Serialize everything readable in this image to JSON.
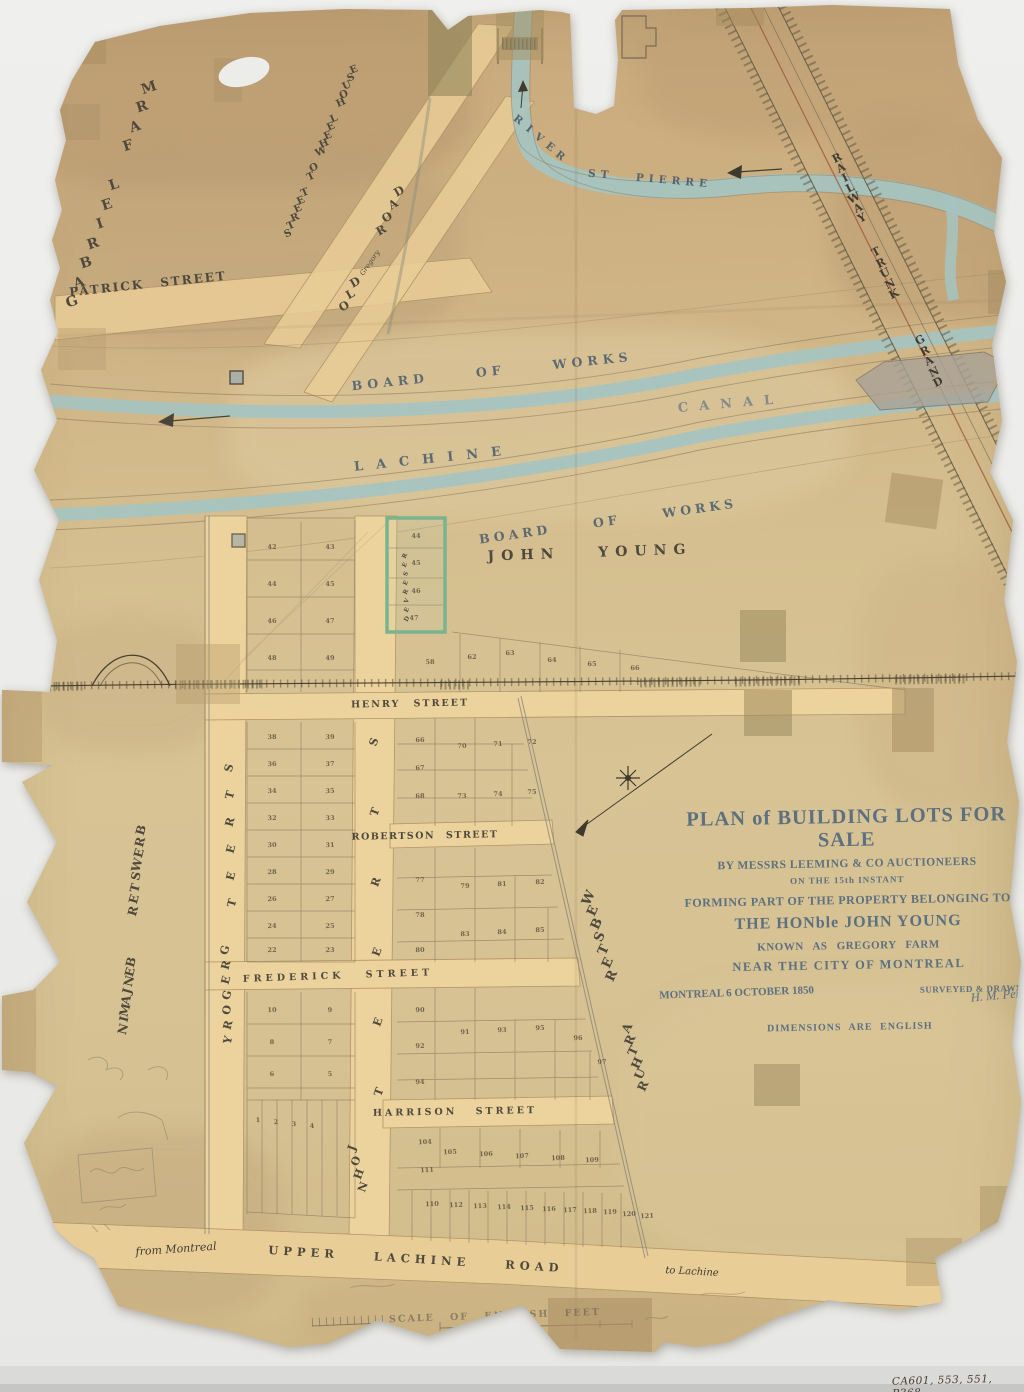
{
  "colors": {
    "paper": "#d2bb8c",
    "street_fill": "#e9cd96",
    "water": "#a4c4c2",
    "ink": "#4e493c",
    "survey_blue": "#5e6a72",
    "title_ink": "#5d7080",
    "reserved_green": "#79b48f"
  },
  "title_block": {
    "line1": "PLAN of BUILDING LOTS FOR SALE",
    "line2": "BY MESSRS LEEMING & CO AUCTIONEERS",
    "line3": "ON THE 15th INSTANT",
    "line4": "FORMING PART OF THE PROPERTY BELONGING TO",
    "line5": "THE HONble JOHN YOUNG",
    "line6": "KNOWN AS GREGORY FARM",
    "line7": "NEAR THE CITY OF MONTREAL",
    "dateline": "MONTREAL 6 OCTOBER 1850",
    "surveyor_label": "SURVEYED & DRAWN BY",
    "surveyor_signature": "H. M. Perrault",
    "dimensions_note": "DIMENSIONS ARE ENGLISH"
  },
  "archival_note": "CA601, 553, 551, P368",
  "map_labels": [
    {
      "name": "gabriel-farm-label",
      "text": "GABRIEL FARM",
      "x": 72,
      "y": 302,
      "rot": -18,
      "size": 14,
      "stack": {
        "dx": 7,
        "dy": -19.5
      }
    },
    {
      "name": "patrick-street-label",
      "text": "PATRICK STREET",
      "x": 148,
      "y": 284,
      "rot": -6,
      "size": 12,
      "ls": 2,
      "ws": 10
    },
    {
      "name": "street-to-wheel-house-label",
      "text": "STREET TO WHEEL HOUSE",
      "x": 288,
      "y": 234,
      "rot": -24,
      "size": 10,
      "stack": {
        "dx": 3.3,
        "dy": -8.2
      }
    },
    {
      "name": "old-road-label-old",
      "text": "OLD",
      "x": 344,
      "y": 306,
      "rot": -30,
      "size": 11.5,
      "stack": {
        "dx": 5.5,
        "dy": -12
      }
    },
    {
      "name": "old-road-label-mid",
      "text": "Gregory",
      "x": 370,
      "y": 263,
      "rot": -55,
      "size": 7,
      "script": true
    },
    {
      "name": "old-road-label-road",
      "text": "ROAD",
      "x": 381,
      "y": 230,
      "rot": -30,
      "size": 11.5,
      "stack": {
        "dx": 6,
        "dy": -13
      }
    },
    {
      "name": "river-label",
      "text": "RIVER",
      "x": 518,
      "y": 120,
      "rot": 38,
      "size": 10.5,
      "color": "#57636b",
      "stack": {
        "dx": 10.5,
        "dy": 9
      }
    },
    {
      "name": "st-pierre-label",
      "text": "ST PIERRE",
      "x": 650,
      "y": 179,
      "rot": 5,
      "size": 10.5,
      "ls": 5,
      "ws": 14,
      "color": "#57636b"
    },
    {
      "name": "board-of-works-upper-label",
      "text": "BOARD OF WORKS",
      "x": 492,
      "y": 371,
      "rot": -6,
      "size": 12.5,
      "ls": 5,
      "ws": 38,
      "color": "#5e6a72"
    },
    {
      "name": "lachine-label",
      "text": "LACHINE",
      "x": 434,
      "y": 459,
      "rot": -6,
      "size": 13,
      "ls": 13,
      "color": "#5e6a72"
    },
    {
      "name": "canal-label",
      "text": "CANAL",
      "x": 731,
      "y": 404,
      "rot": -5,
      "size": 13,
      "ls": 11,
      "color": "#76828a",
      "opacity": 0.85
    },
    {
      "name": "board-of-works-lower-label",
      "text": "BOARD OF WORKS",
      "x": 608,
      "y": 521,
      "rot": -8,
      "size": 12.5,
      "ls": 4,
      "ws": 34,
      "color": "#5e6a72"
    },
    {
      "name": "john-young-label",
      "text": "JOHN YOUNG",
      "x": 590,
      "y": 553,
      "rot": -2,
      "size": 14,
      "ls": 7,
      "ws": 26
    },
    {
      "name": "grand-trunk-railway-label-grand",
      "text": "GRAND",
      "x": 920,
      "y": 340,
      "rot": -28,
      "size": 11,
      "color": "#3f3b33",
      "stack": {
        "dx": 4.5,
        "dy": 10.5
      }
    },
    {
      "name": "grand-trunk-railway-label-trunk",
      "text": "TRUNK",
      "x": 876,
      "y": 252,
      "rot": -28,
      "size": 11,
      "color": "#3f3b33",
      "stack": {
        "dx": 4.5,
        "dy": 10.5
      }
    },
    {
      "name": "grand-trunk-railway-label-railway",
      "text": "RAILWAY",
      "x": 837,
      "y": 158,
      "rot": -28,
      "size": 11,
      "color": "#3f3b33",
      "stack": {
        "dx": 4.2,
        "dy": 10
      }
    },
    {
      "name": "henry-street-label",
      "text": "HENRY STREET",
      "x": 410,
      "y": 704,
      "rot": -1,
      "size": 9.5,
      "ls": 2,
      "ws": 8
    },
    {
      "name": "robertson-street-label",
      "text": "ROBERTSON STREET",
      "x": 425,
      "y": 836,
      "rot": -1,
      "size": 9.5,
      "ls": 1.5,
      "ws": 6
    },
    {
      "name": "frederick-street-label",
      "text": "FREDERICK STREET",
      "x": 338,
      "y": 976,
      "rot": -2,
      "size": 9.5,
      "ls": 4,
      "ws": 14
    },
    {
      "name": "harrison-street-label",
      "text": "HARRISON STREET",
      "x": 455,
      "y": 1112,
      "rot": -1,
      "size": 9.5,
      "ls": 3,
      "ws": 12
    },
    {
      "name": "gregory-street-label-street",
      "text": "STREET",
      "x": 229,
      "y": 768,
      "rot": -75,
      "size": 11,
      "stack": {
        "dx": 0.5,
        "dy": 27
      }
    },
    {
      "name": "gregory-street-label-gregory",
      "text": "GREGORY",
      "x": 225,
      "y": 950,
      "rot": -75,
      "size": 11,
      "stack": {
        "dx": 0.5,
        "dy": 15
      }
    },
    {
      "name": "john-street-label-street",
      "text": "STREET",
      "x": 374,
      "y": 742,
      "rot": -70,
      "size": 11,
      "stack": {
        "dx": 1,
        "dy": 70
      }
    },
    {
      "name": "john-street-label-john",
      "text": "JOHN",
      "x": 352,
      "y": 1148,
      "rot": -70,
      "size": 11,
      "stack": {
        "dx": 3.5,
        "dy": 13
      }
    },
    {
      "name": "webster-label",
      "text": "WEBSTER",
      "x": 589,
      "y": 898,
      "rot": -65,
      "size": 13,
      "stack": {
        "dx": 3.8,
        "dy": 13
      }
    },
    {
      "name": "arthur-label",
      "text": "ARTHUR",
      "x": 627,
      "y": 1028,
      "rot": -65,
      "size": 12,
      "stack": {
        "dx": 3.2,
        "dy": 11.5
      }
    },
    {
      "name": "benjamin-brewster-label-benjamin",
      "text": "BENJAMIN",
      "x": 131,
      "y": 962,
      "rot": -75,
      "size": 12,
      "stack": {
        "dx": -1.2,
        "dy": 9.5
      }
    },
    {
      "name": "benjamin-brewster-label-brewster",
      "text": "BREWSTER",
      "x": 141,
      "y": 830,
      "rot": -75,
      "size": 12,
      "stack": {
        "dx": -1.2,
        "dy": 11.5
      }
    },
    {
      "name": "reserved-label",
      "text": "RESERVED",
      "x": 405,
      "y": 556,
      "rot": -65,
      "size": 6,
      "stack": {
        "dx": 0.3,
        "dy": 9
      }
    },
    {
      "name": "upper-lachine-road-label",
      "text": "UPPER LACHINE ROAD",
      "x": 416,
      "y": 1259,
      "rot": 3.5,
      "size": 11.5,
      "ls": 5,
      "ws": 26
    },
    {
      "name": "from-montreal-label",
      "text": "from Montreal",
      "x": 176,
      "y": 1249,
      "rot": -4,
      "size": 11,
      "script": true,
      "color": "#3f3b33"
    },
    {
      "name": "to-lachine-label",
      "text": "to Lachine",
      "x": 692,
      "y": 1272,
      "rot": 3,
      "size": 10,
      "script": true,
      "color": "#3f3b33"
    },
    {
      "name": "scale-caption",
      "text": "SCALE OF ENGLISH FEET",
      "x": 495,
      "y": 1316,
      "rot": -2,
      "size": 9.5,
      "ls": 2,
      "ws": 10,
      "color": "#6a6254",
      "opacity": 0.65
    }
  ],
  "lot_numbers": [
    [
      "42",
      272,
      547
    ],
    [
      "43",
      330,
      547
    ],
    [
      "44",
      272,
      584
    ],
    [
      "45",
      330,
      584
    ],
    [
      "46",
      272,
      621
    ],
    [
      "47",
      330,
      621
    ],
    [
      "48",
      272,
      658
    ],
    [
      "49",
      330,
      658
    ],
    [
      "44",
      416,
      536
    ],
    [
      "45",
      416,
      563
    ],
    [
      "46",
      416,
      591
    ],
    [
      "47",
      414,
      618
    ],
    [
      "58",
      430,
      662
    ],
    [
      "62",
      472,
      657
    ],
    [
      "63",
      510,
      653
    ],
    [
      "64",
      552,
      660
    ],
    [
      "65",
      592,
      664
    ],
    [
      "66",
      635,
      668
    ],
    [
      "66",
      420,
      740
    ],
    [
      "67",
      420,
      768
    ],
    [
      "68",
      420,
      796
    ],
    [
      "70",
      462,
      746
    ],
    [
      "71",
      498,
      744
    ],
    [
      "72",
      532,
      742
    ],
    [
      "73",
      462,
      796
    ],
    [
      "74",
      498,
      794
    ],
    [
      "75",
      532,
      792
    ],
    [
      "38",
      272,
      737
    ],
    [
      "39",
      330,
      737
    ],
    [
      "36",
      272,
      764
    ],
    [
      "37",
      330,
      764
    ],
    [
      "34",
      272,
      791
    ],
    [
      "35",
      330,
      791
    ],
    [
      "32",
      272,
      818
    ],
    [
      "33",
      330,
      818
    ],
    [
      "30",
      272,
      845
    ],
    [
      "31",
      330,
      845
    ],
    [
      "28",
      272,
      872
    ],
    [
      "29",
      330,
      872
    ],
    [
      "26",
      272,
      899
    ],
    [
      "27",
      330,
      899
    ],
    [
      "24",
      272,
      926
    ],
    [
      "25",
      330,
      926
    ],
    [
      "22",
      272,
      950
    ],
    [
      "23",
      330,
      950
    ],
    [
      "77",
      420,
      880
    ],
    [
      "78",
      420,
      915
    ],
    [
      "80",
      420,
      950
    ],
    [
      "79",
      465,
      886
    ],
    [
      "81",
      502,
      884
    ],
    [
      "82",
      540,
      882
    ],
    [
      "83",
      465,
      934
    ],
    [
      "84",
      502,
      932
    ],
    [
      "85",
      540,
      930
    ],
    [
      "90",
      420,
      1010
    ],
    [
      "92",
      420,
      1046
    ],
    [
      "94",
      420,
      1082
    ],
    [
      "91",
      465,
      1032
    ],
    [
      "93",
      502,
      1030
    ],
    [
      "95",
      540,
      1028
    ],
    [
      "96",
      578,
      1038
    ],
    [
      "97",
      602,
      1062
    ],
    [
      "10",
      272,
      1010
    ],
    [
      "9",
      330,
      1010
    ],
    [
      "8",
      272,
      1042
    ],
    [
      "7",
      330,
      1042
    ],
    [
      "6",
      272,
      1074
    ],
    [
      "5",
      330,
      1074
    ],
    [
      "1",
      258,
      1120
    ],
    [
      "2",
      276,
      1122
    ],
    [
      "3",
      294,
      1124
    ],
    [
      "4",
      312,
      1126
    ],
    [
      "104",
      425,
      1142
    ],
    [
      "105",
      450,
      1152
    ],
    [
      "106",
      486,
      1154
    ],
    [
      "107",
      522,
      1156
    ],
    [
      "108",
      558,
      1158
    ],
    [
      "109",
      592,
      1160
    ],
    [
      "111",
      427,
      1170
    ],
    [
      "110",
      432,
      1204
    ],
    [
      "112",
      456,
      1205
    ],
    [
      "113",
      480,
      1206
    ],
    [
      "114",
      504,
      1207
    ],
    [
      "115",
      527,
      1208
    ],
    [
      "116",
      549,
      1209
    ],
    [
      "117",
      570,
      1210
    ],
    [
      "118",
      590,
      1211
    ],
    [
      "119",
      610,
      1212
    ],
    [
      "120",
      629,
      1214
    ],
    [
      "121",
      647,
      1216
    ]
  ]
}
